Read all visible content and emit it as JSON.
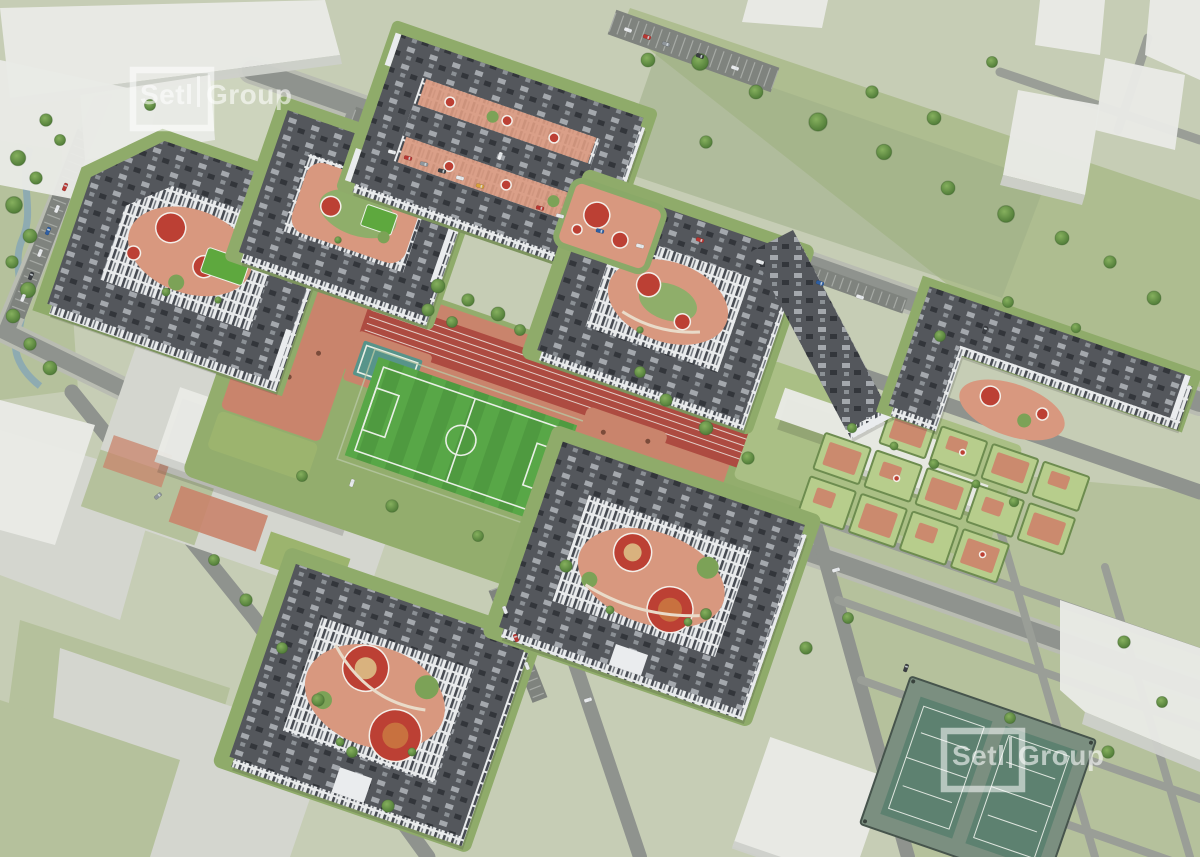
{
  "watermark": {
    "setl": "Setl",
    "group": "Group"
  },
  "palette": {
    "ground": "#c6cdb5",
    "meadow": "#aebd90",
    "road_grey": "#8f938e",
    "minor_road_grey": "#9a9e97",
    "ghost_building_white": "#e9eae6",
    "roof_dark_grey": "#54575c",
    "facade_white": "#e9ebec",
    "courtyard_green": "#8fab6a",
    "courtyard_path_salmon": "#d8987f",
    "playground_red": "#bc4034",
    "soccer_pitch_green": "#4f9a40",
    "running_track_red": "#ad4b41",
    "basketball_teal": "#57948a",
    "tennis_court_green": "#5d8170",
    "canal_water": "#8aa9b4",
    "tree_green": "#557f3e",
    "car_red": "#b93733",
    "car_blue": "#2e5fa3",
    "car_yellow": "#d9a13b",
    "watermark_white": "#ffffff"
  }
}
